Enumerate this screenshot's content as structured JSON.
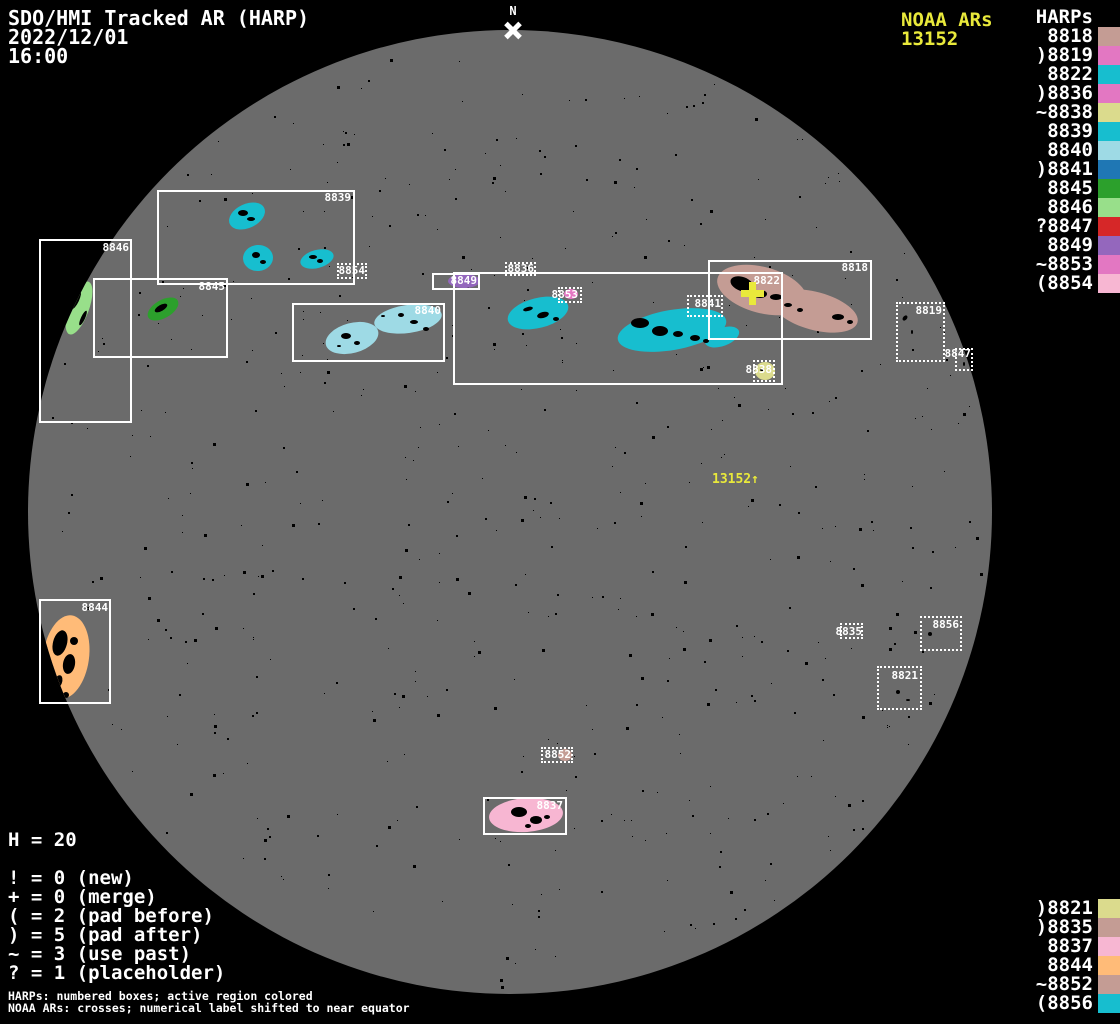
{
  "header": {
    "title": "SDO/HMI Tracked AR (HARP)",
    "date": "2022/12/01",
    "time": "16:00",
    "north_label": "N",
    "noaa_title": "NOAA ARs",
    "noaa_number": "13152",
    "harps_title": "HARPs"
  },
  "colors": {
    "background": "#000000",
    "disk": "#6b6b6b",
    "accent_yellow": "#e9e93b",
    "box_white": "#ffffff"
  },
  "harp_list_top": [
    {
      "prefix": "",
      "number": "8818",
      "label": "8818",
      "color": "#c49c94"
    },
    {
      "prefix": ")",
      "number": "8819",
      "label": ")8819",
      "color": "#e377c2"
    },
    {
      "prefix": "",
      "number": "8822",
      "label": "8822",
      "color": "#17becf"
    },
    {
      "prefix": ")",
      "number": "8836",
      "label": ")8836",
      "color": "#e377c2"
    },
    {
      "prefix": "~",
      "number": "8838",
      "label": "~8838",
      "color": "#dbdb8d"
    },
    {
      "prefix": "",
      "number": "8839",
      "label": "8839",
      "color": "#17becf"
    },
    {
      "prefix": "",
      "number": "8840",
      "label": "8840",
      "color": "#9edae5"
    },
    {
      "prefix": ")",
      "number": "8841",
      "label": ")8841",
      "color": "#1f77b4"
    },
    {
      "prefix": "",
      "number": "8845",
      "label": "8845",
      "color": "#2ca02c"
    },
    {
      "prefix": "",
      "number": "8846",
      "label": "8846",
      "color": "#98df8a"
    },
    {
      "prefix": "?",
      "number": "8847",
      "label": "?8847",
      "color": "#d62728"
    },
    {
      "prefix": "",
      "number": "8849",
      "label": "8849",
      "color": "#9467bd"
    },
    {
      "prefix": "~",
      "number": "8853",
      "label": "~8853",
      "color": "#e377c2"
    },
    {
      "prefix": "(",
      "number": "8854",
      "label": "(8854",
      "color": "#f7b6d2"
    }
  ],
  "harp_list_bottom": [
    {
      "prefix": ")",
      "number": "8821",
      "label": ")8821",
      "color": "#dbdb8d"
    },
    {
      "prefix": ")",
      "number": "8835",
      "label": ")8835",
      "color": "#c49c94"
    },
    {
      "prefix": "",
      "number": "8837",
      "label": "8837",
      "color": "#f7b6d2"
    },
    {
      "prefix": "",
      "number": "8844",
      "label": "8844",
      "color": "#ffbb78"
    },
    {
      "prefix": "~",
      "number": "8852",
      "label": "~8852",
      "color": "#c49c94"
    },
    {
      "prefix": "(",
      "number": "8856",
      "label": "(8856",
      "color": "#17becf"
    }
  ],
  "legend": {
    "h_count": "H = 20",
    "rows": [
      "! = 0 (new)",
      "+ = 0 (merge)",
      "( = 2 (pad before)",
      ") = 5 (pad after)",
      "~ = 3 (use past)",
      "? = 1 (placeholder)"
    ],
    "footnote1": "HARPs: numbered boxes; active region colored",
    "footnote2": "NOAA ARs: crosses; numerical label shifted to near equator"
  },
  "chart_data": {
    "type": "scatter",
    "title": "SDO/HMI Tracked AR (HARP)",
    "datetime": "2022/12/01 16:00",
    "disk": {
      "cx": 510,
      "cy": 512,
      "r": 482
    },
    "north_marker": {
      "label": "N",
      "px": [
        513,
        30
      ]
    },
    "noaa_ars": [
      {
        "number": "13152",
        "cross_px": [
          752,
          293
        ],
        "equator_label": "13152↑",
        "label_px": [
          712,
          472
        ]
      }
    ],
    "harps": [
      {
        "number": "8839",
        "style": "solid",
        "color": "#17becf",
        "box": [
          157,
          190,
          355,
          285
        ],
        "label_anchor": [
          351,
          191
        ],
        "blobs": [
          [
            247,
            216,
            19,
            12,
            -25
          ],
          [
            258,
            258,
            15,
            13,
            -5
          ],
          [
            317,
            259,
            17,
            9,
            -15
          ]
        ],
        "spots": [
          [
            243,
            213,
            5,
            3,
            0
          ],
          [
            251,
            219,
            4,
            2,
            0
          ],
          [
            256,
            255,
            4,
            3,
            0
          ],
          [
            263,
            262,
            3,
            2,
            0
          ],
          [
            313,
            257,
            4,
            2,
            0
          ],
          [
            320,
            261,
            3,
            2,
            0
          ]
        ]
      },
      {
        "number": "8846",
        "style": "solid",
        "color": "#98df8a",
        "box": [
          39,
          239,
          132,
          423
        ],
        "label_anchor": [
          129,
          241
        ],
        "blobs": [
          [
            79,
            308,
            10,
            28,
            20
          ]
        ],
        "spots": [
          [
            76,
            300,
            3,
            10,
            25
          ],
          [
            83,
            318,
            2,
            8,
            25
          ]
        ]
      },
      {
        "number": "8845",
        "style": "solid",
        "color": "#2ca02c",
        "box": [
          93,
          278,
          228,
          358
        ],
        "label_anchor": [
          225,
          280
        ],
        "blobs": [
          [
            163,
            309,
            17,
            9,
            -30
          ]
        ],
        "spots": [
          [
            161,
            308,
            7,
            3,
            -30
          ]
        ]
      },
      {
        "number": "8854",
        "style": "dotted",
        "color": "#f7b6d2",
        "box": [
          337,
          263,
          367,
          279
        ],
        "label_anchor": [
          365,
          264
        ],
        "blobs": [],
        "spots": []
      },
      {
        "number": "8840",
        "style": "solid",
        "color": "#9edae5",
        "box": [
          292,
          303,
          445,
          362
        ],
        "label_anchor": [
          441,
          304
        ],
        "blobs": [
          [
            352,
            338,
            27,
            15,
            -15
          ],
          [
            408,
            319,
            34,
            14,
            -8
          ]
        ],
        "spots": [
          [
            346,
            336,
            5,
            3,
            0
          ],
          [
            357,
            343,
            3,
            2,
            0
          ],
          [
            339,
            346,
            2,
            1,
            0
          ],
          [
            401,
            315,
            3,
            2,
            0
          ],
          [
            414,
            322,
            4,
            2,
            0
          ],
          [
            426,
            329,
            3,
            2,
            0
          ],
          [
            383,
            316,
            2,
            1,
            0
          ]
        ]
      },
      {
        "number": "8849",
        "style": "solid",
        "color": "#9467bd",
        "box": [
          432,
          273,
          480,
          290
        ],
        "label_anchor": [
          477,
          274
        ],
        "blobs": [
          [
            464,
            281,
            16,
            7,
            0
          ]
        ],
        "spots": []
      },
      {
        "number": "8836",
        "style": "dotted",
        "color": "#e377c2",
        "box": [
          505,
          262,
          536,
          276
        ],
        "label_anchor": [
          534,
          262
        ],
        "blobs": [],
        "spots": []
      },
      {
        "number": "8822",
        "style": "solid",
        "color": "#17becf",
        "box": [
          453,
          272,
          783,
          385
        ],
        "label_anchor": [
          780,
          274
        ],
        "blobs": [
          [
            538,
            313,
            31,
            15,
            -14
          ],
          [
            672,
            330,
            55,
            20,
            -10
          ],
          [
            722,
            337,
            18,
            9,
            -20
          ]
        ],
        "spots": [
          [
            528,
            309,
            5,
            2,
            -15
          ],
          [
            543,
            315,
            6,
            3,
            -15
          ],
          [
            556,
            319,
            3,
            2,
            0
          ],
          [
            640,
            323,
            9,
            5,
            0
          ],
          [
            660,
            331,
            8,
            5,
            0
          ],
          [
            678,
            334,
            5,
            3,
            0
          ],
          [
            695,
            338,
            5,
            3,
            0
          ],
          [
            706,
            341,
            3,
            2,
            0
          ]
        ]
      },
      {
        "number": "8818",
        "style": "solid",
        "color": "#c49c94",
        "box": [
          708,
          260,
          872,
          340
        ],
        "label_anchor": [
          868,
          261
        ],
        "blobs": [
          [
            762,
            290,
            46,
            23,
            15
          ],
          [
            815,
            311,
            44,
            19,
            15
          ]
        ],
        "spots": [
          [
            742,
            284,
            12,
            7,
            20
          ],
          [
            760,
            294,
            7,
            4,
            0
          ],
          [
            776,
            297,
            6,
            3,
            0
          ],
          [
            788,
            305,
            4,
            2,
            0
          ],
          [
            800,
            310,
            3,
            2,
            0
          ],
          [
            838,
            317,
            6,
            3,
            0
          ],
          [
            850,
            322,
            3,
            2,
            0
          ]
        ]
      },
      {
        "number": "8853",
        "style": "dotted",
        "color": "#e377c2",
        "box": [
          558,
          287,
          582,
          303
        ],
        "label_anchor": [
          578,
          288
        ],
        "blobs": [
          [
            571,
            294,
            7,
            5,
            0
          ]
        ],
        "spots": []
      },
      {
        "number": "8841",
        "style": "dotted",
        "color": "#1f77b4",
        "box": [
          687,
          295,
          723,
          317
        ],
        "label_anchor": [
          721,
          297
        ],
        "blobs": [],
        "spots": []
      },
      {
        "number": "8838",
        "style": "dotted",
        "color": "#dbdb8d",
        "box": [
          753,
          360,
          775,
          382
        ],
        "label_anchor": [
          772,
          363
        ],
        "blobs": [
          [
            765,
            371,
            10,
            9,
            0
          ]
        ],
        "spots": [
          [
            762,
            370,
            2,
            1,
            0
          ]
        ]
      },
      {
        "number": "8819",
        "style": "dotted",
        "color": "#e377c2",
        "box": [
          896,
          302,
          945,
          362
        ],
        "label_anchor": [
          942,
          304
        ],
        "blobs": [],
        "spots": [
          [
            905,
            318,
            2,
            3,
            40
          ],
          [
            912,
            332,
            1,
            2,
            0
          ]
        ]
      },
      {
        "number": "8847",
        "style": "dotted",
        "color": "#d62728",
        "box": [
          955,
          348,
          973,
          371
        ],
        "label_anchor": [
          971,
          347
        ],
        "blobs": [],
        "spots": [
          [
            964,
            364,
            1,
            2,
            0
          ]
        ]
      },
      {
        "number": "8844",
        "style": "solid",
        "color": "#ffbb78",
        "box": [
          39,
          599,
          111,
          704
        ],
        "label_anchor": [
          108,
          601
        ],
        "blobs": [
          [
            66,
            657,
            23,
            42,
            8
          ]
        ],
        "spots": [
          [
            60,
            643,
            7,
            13,
            15
          ],
          [
            69,
            664,
            6,
            10,
            10
          ],
          [
            58,
            682,
            4,
            7,
            20
          ],
          [
            74,
            641,
            4,
            4,
            0
          ],
          [
            66,
            695,
            3,
            3,
            0
          ]
        ]
      },
      {
        "number": "8835",
        "style": "dotted",
        "color": "#c49c94",
        "box": [
          840,
          623,
          863,
          639
        ],
        "label_anchor": [
          862,
          625
        ],
        "blobs": [],
        "spots": []
      },
      {
        "number": "8856",
        "style": "dotted",
        "color": "#17becf",
        "box": [
          920,
          616,
          962,
          651
        ],
        "label_anchor": [
          959,
          618
        ],
        "blobs": [],
        "spots": [
          [
            930,
            634,
            2,
            2,
            0
          ]
        ]
      },
      {
        "number": "8821",
        "style": "dotted",
        "color": "#dbdb8d",
        "box": [
          877,
          666,
          922,
          710
        ],
        "label_anchor": [
          918,
          669
        ],
        "blobs": [],
        "spots": [
          [
            898,
            692,
            2,
            2,
            0
          ],
          [
            908,
            700,
            2,
            1,
            0
          ]
        ]
      },
      {
        "number": "8852",
        "style": "dotted",
        "color": "#c49c94",
        "box": [
          541,
          747,
          573,
          763
        ],
        "label_anchor": [
          571,
          748
        ],
        "blobs": [
          [
            565,
            755,
            7,
            6,
            0
          ]
        ],
        "spots": []
      },
      {
        "number": "8837",
        "style": "solid",
        "color": "#f7b6d2",
        "box": [
          483,
          797,
          567,
          835
        ],
        "label_anchor": [
          563,
          799
        ],
        "blobs": [
          [
            526,
            815,
            37,
            17,
            -4
          ]
        ],
        "spots": [
          [
            519,
            812,
            8,
            5,
            0
          ],
          [
            536,
            820,
            6,
            4,
            0
          ],
          [
            528,
            826,
            3,
            2,
            0
          ],
          [
            547,
            817,
            3,
            2,
            0
          ]
        ]
      }
    ]
  }
}
